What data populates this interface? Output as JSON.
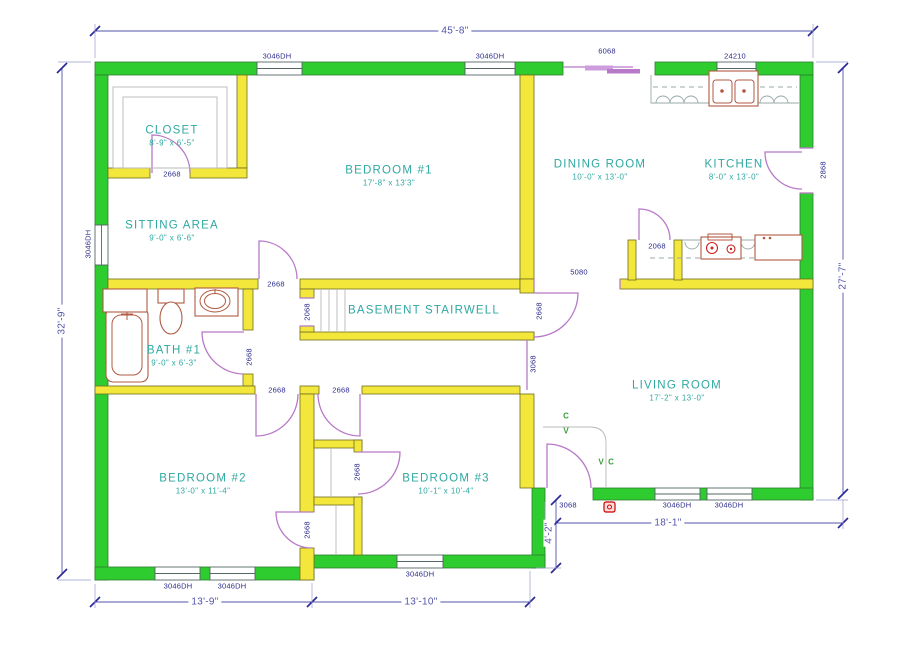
{
  "drawing_title": "Residential Floor Plan",
  "colors": {
    "wall_exterior": "#2ecc2e",
    "wall_interior": "#f3e73b",
    "door": "#b879c8",
    "room_label": "#2fa8a2",
    "tag_label": "#2b2b8c",
    "dimension": "#5353ab",
    "fixture": "#b05a42"
  },
  "rooms": [
    {
      "id": "closet",
      "name": "CLOSET",
      "size": "8'-9\" x 6'-5\"",
      "x": 172,
      "y": 136
    },
    {
      "id": "sitting",
      "name": "SITTING AREA",
      "size": "9'-0\" x 6'-6\"",
      "x": 172,
      "y": 231
    },
    {
      "id": "bedroom1",
      "name": "BEDROOM #1",
      "size": "17'-8\" x 13'3\"",
      "x": 389,
      "y": 176
    },
    {
      "id": "dining",
      "name": "DINING ROOM",
      "size": "10'-0\" x 13'-0\"",
      "x": 600,
      "y": 170
    },
    {
      "id": "kitchen",
      "name": "KITCHEN",
      "size": "8'-0\" x 13'-0\"",
      "x": 734,
      "y": 170
    },
    {
      "id": "bath1",
      "name": "BATH #1",
      "size": "9'-0\" x 6'-3\"",
      "x": 174,
      "y": 356
    },
    {
      "id": "stairwell",
      "name": "BASEMENT STAIRWELL",
      "size": "",
      "x": 424,
      "y": 311
    },
    {
      "id": "living",
      "name": "LIVING ROOM",
      "size": "17'-2\" x 13'-0\"",
      "x": 677,
      "y": 391
    },
    {
      "id": "bedroom2",
      "name": "BEDROOM #2",
      "size": "13'-0\" x 11'-4\"",
      "x": 203,
      "y": 484
    },
    {
      "id": "bedroom3",
      "name": "BEDROOM #3",
      "size": "10'-1\" x 10'-4\"",
      "x": 446,
      "y": 484
    }
  ],
  "tags": [
    {
      "id": "window-top-1",
      "text": "3046DH",
      "x": 277,
      "y": 56,
      "rot": 0
    },
    {
      "id": "window-top-2",
      "text": "3046DH",
      "x": 490,
      "y": 56,
      "rot": 0
    },
    {
      "id": "slider-top",
      "text": "6068",
      "x": 607,
      "y": 51,
      "rot": 0
    },
    {
      "id": "window-kitchen",
      "text": "24210",
      "x": 735,
      "y": 56,
      "rot": 0
    },
    {
      "id": "window-left",
      "text": "3046DH",
      "x": 88,
      "y": 244,
      "rot": -90
    },
    {
      "id": "door-kitchen-side",
      "text": "2868",
      "x": 823,
      "y": 170,
      "rot": -90
    },
    {
      "id": "door-closet1",
      "text": "2668",
      "x": 172,
      "y": 174,
      "rot": 0
    },
    {
      "id": "door-bedroom1",
      "text": "2668",
      "x": 276,
      "y": 284,
      "rot": 0
    },
    {
      "id": "opening-stairs",
      "text": "2068",
      "x": 307,
      "y": 312,
      "rot": -90
    },
    {
      "id": "door-stairs",
      "text": "2668",
      "x": 539,
      "y": 311,
      "rot": -90
    },
    {
      "id": "door-bath",
      "text": "2668",
      "x": 249,
      "y": 357,
      "rot": -90
    },
    {
      "id": "opening-hall",
      "text": "3068",
      "x": 533,
      "y": 364,
      "rot": -90
    },
    {
      "id": "opening-dining",
      "text": "5080",
      "x": 579,
      "y": 272,
      "rot": 0
    },
    {
      "id": "door-pantry",
      "text": "2068",
      "x": 657,
      "y": 246,
      "rot": 0
    },
    {
      "id": "door-bedroom2",
      "text": "2668",
      "x": 277,
      "y": 390,
      "rot": 0
    },
    {
      "id": "door-bedroom3",
      "text": "2668",
      "x": 341,
      "y": 390,
      "rot": 0
    },
    {
      "id": "door-closet-bed3",
      "text": "2668",
      "x": 357,
      "y": 472,
      "rot": -90
    },
    {
      "id": "door-closet-bed2",
      "text": "2668",
      "x": 307,
      "y": 530,
      "rot": -90
    },
    {
      "id": "door-front",
      "text": "3068",
      "x": 568,
      "y": 505,
      "rot": 0
    },
    {
      "id": "window-bed2-1",
      "text": "3046DH",
      "x": 178,
      "y": 586,
      "rot": 0
    },
    {
      "id": "window-bed2-2",
      "text": "3046DH",
      "x": 232,
      "y": 586,
      "rot": 0
    },
    {
      "id": "window-bed3",
      "text": "3046DH",
      "x": 420,
      "y": 574,
      "rot": 0
    },
    {
      "id": "window-living-1",
      "text": "3046DH",
      "x": 677,
      "y": 505,
      "rot": 0
    },
    {
      "id": "window-living-2",
      "text": "3046DH",
      "x": 729,
      "y": 505,
      "rot": 0
    }
  ],
  "dimensions": [
    {
      "id": "overall-width",
      "text": "45'-8\"",
      "x": 455,
      "y": 31,
      "rot": 0
    },
    {
      "id": "overall-left",
      "text": "32'-9\"",
      "x": 62,
      "y": 321,
      "rot": -90
    },
    {
      "id": "overall-right",
      "text": "27'-7\"",
      "x": 843,
      "y": 276,
      "rot": -90
    },
    {
      "id": "bottom-left",
      "text": "13'-9\"",
      "x": 205,
      "y": 602,
      "rot": 0
    },
    {
      "id": "bottom-mid",
      "text": "13'-10\"",
      "x": 421,
      "y": 602,
      "rot": 0
    },
    {
      "id": "bottom-right",
      "text": "18'-1\"",
      "x": 668,
      "y": 523,
      "rot": 0
    },
    {
      "id": "entry-depth",
      "text": "4'-2\"",
      "x": 549,
      "y": 533,
      "rot": -90
    }
  ],
  "markers": [
    {
      "id": "closet-marker-c1",
      "text": "C",
      "x": 566,
      "y": 416
    },
    {
      "id": "closet-marker-v1",
      "text": "V",
      "x": 566,
      "y": 431
    },
    {
      "id": "closet-marker-v2",
      "text": "V",
      "x": 601,
      "y": 462
    },
    {
      "id": "closet-marker-c2",
      "text": "C",
      "x": 611,
      "y": 462
    }
  ]
}
